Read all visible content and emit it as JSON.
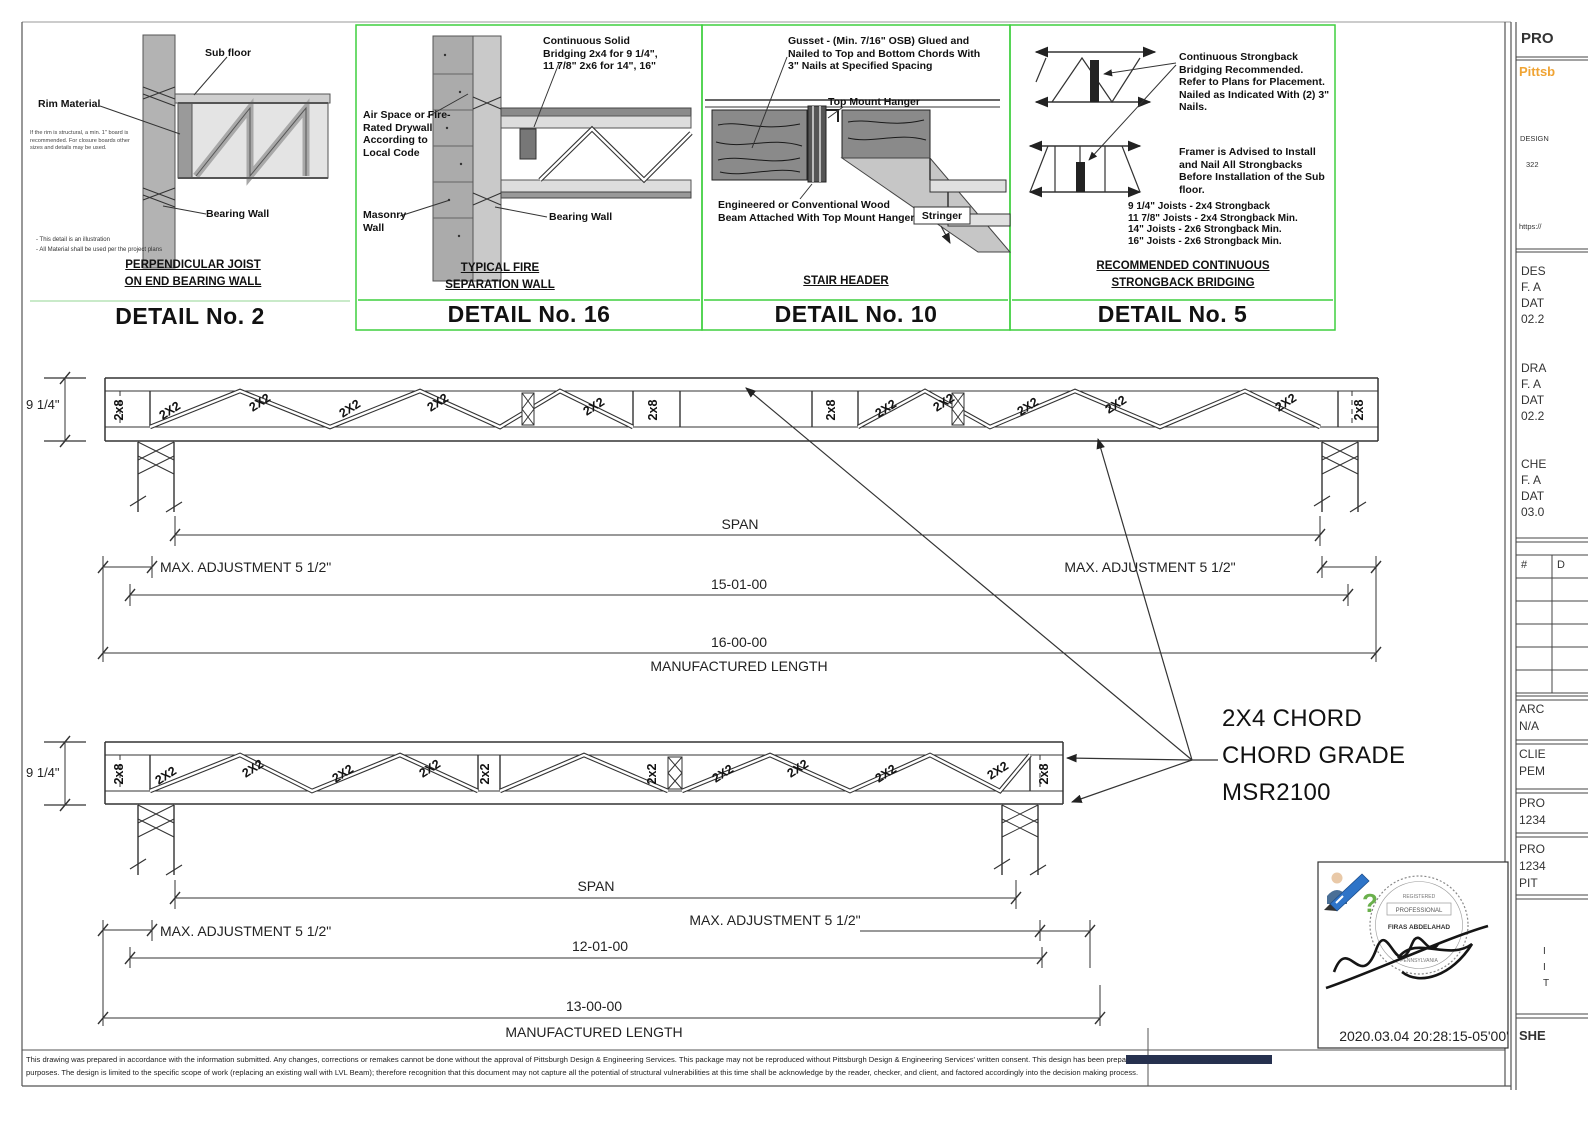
{
  "sheet": {
    "details": [
      {
        "label": "DETAIL No. 2",
        "caption": [
          "PERPENDICULAR JOIST",
          "ON END BEARING WALL"
        ],
        "callouts": {
          "sub_floor": "Sub floor",
          "rim": "Rim Material",
          "bearing": "Bearing Wall"
        },
        "note": "If the rim is structural, a min. 1\" board is recommended. For closure boards other sizes and details may be used.",
        "footnote1": "- This detail is an illustration",
        "footnote2": "- All Material shall be used per the project plans"
      },
      {
        "label": "DETAIL No. 16",
        "caption": [
          "TYPICAL FIRE",
          "SEPARATION WALL"
        ],
        "callouts": {
          "bridging": "Continuous Solid Bridging 2x4 for 9 1/4\", 11 7/8\" 2x6 for 14\", 16\"",
          "air_space": "Air Space or Fire-Rated Drywall According to Local Code",
          "masonry": "Masonry Wall",
          "bearing": "Bearing Wall"
        }
      },
      {
        "label": "DETAIL No. 10",
        "caption": [
          "STAIR HEADER"
        ],
        "callouts": {
          "gusset": "Gusset - (Min. 7/16\" OSB) Glued and Nailed to Top and Bottom Chords With 3\" Nails at Specified Spacing",
          "hanger": "Top Mount Hanger",
          "beam": "Engineered or Conventional Wood Beam Attached With Top Mount Hanger",
          "stringer": "Stringer"
        }
      },
      {
        "label": "DETAIL No. 5",
        "caption": [
          "RECOMMENDED CONTINUOUS",
          "STRONGBACK BRIDGING"
        ],
        "callouts": {
          "strongback": "Continuous Strongback Bridging Recommended. Refer to Plans for Placement. Nailed as Indicated With (2) 3\" Nails.",
          "framer": "Framer is Advised to Install and Nail All Strongbacks Before Installation of the Sub floor."
        },
        "spec": [
          "9 1/4\" Joists - 2x4 Strongback",
          "11 7/8\" Joists - 2x4 Strongback Min.",
          "14\" Joists - 2x6 Strongback Min.",
          "16\" Joists - 2x6 Strongback Min."
        ]
      }
    ],
    "trusses": [
      {
        "depth": "9 1/4\"",
        "end": "2x8",
        "web": "2X2",
        "span": "SPAN",
        "adj": "MAX. ADJUSTMENT 5 1/2\"",
        "dim_span": "15-01-00",
        "dim_overall": "16-00-00",
        "mfg": "MANUFACTURED LENGTH"
      },
      {
        "depth": "9 1/4\"",
        "end": "2x8",
        "mid": "2x2",
        "web": "2X2",
        "span": "SPAN",
        "adj": "MAX. ADJUSTMENT 5 1/2\"",
        "dim_span": "12-01-00",
        "dim_overall": "13-00-00",
        "mfg": "MANUFACTURED LENGTH"
      }
    ],
    "chord_note": {
      "l1": "2X4 CHORD",
      "l2": "CHORD GRADE",
      "l3": "MSR2100"
    },
    "signature": {
      "timestamp": "2020.03.04 20:28:15-05'00'",
      "registered": "REGISTERED",
      "professional": "PROFESSIONAL",
      "name": "FIRAS ABDELAHAD",
      "state": "PENNSYLVANIA",
      "qmark": "?"
    },
    "title_block": {
      "project_header": "PRO",
      "company": "Pittsb",
      "design_label": "DESIGN",
      "address": "322",
      "url": "https://",
      "des": {
        "a": "DES",
        "b": "F. A",
        "c": "DAT",
        "d": "02.2"
      },
      "dra": {
        "a": "DRA",
        "b": "F. A",
        "c": "DAT",
        "d": "02.2"
      },
      "chk": {
        "a": "CHE",
        "b": "F. A",
        "c": "DAT",
        "d": "03.0"
      },
      "rev": {
        "num": "#",
        "desc": "D"
      },
      "arc": {
        "a": "ARC",
        "b": "N/A"
      },
      "cli": {
        "a": "CLIE",
        "b": "PEM"
      },
      "pr1": {
        "a": "PRO",
        "b": "1234"
      },
      "pr2": {
        "a": "PRO",
        "b": "1234",
        "c": "PIT"
      },
      "frag": {
        "a": "I",
        "b": "I",
        "c": "T"
      },
      "sheet_label": "SHE"
    },
    "disclaimer": {
      "part1": "This drawing was prepared in accordance with the information submitted. Any changes, corrections or remakes cannot be done without the approval of Pittsburgh Design & Engineering Services. This package may not be reproduced without Pittsburgh Design & Engineering Services' written consent. This design has been prepa",
      "struck": "red for the client use only and for permitting",
      "line2": "purposes. The design is limited to the specific scope of work (replacing an existing wall with LVL Beam); therefore recognition that this document may not capture all the potential of structural vulnerabilities at this time shall be acknowledge by the reader, checker, and client, and factored accordingly into the decision making process."
    }
  }
}
